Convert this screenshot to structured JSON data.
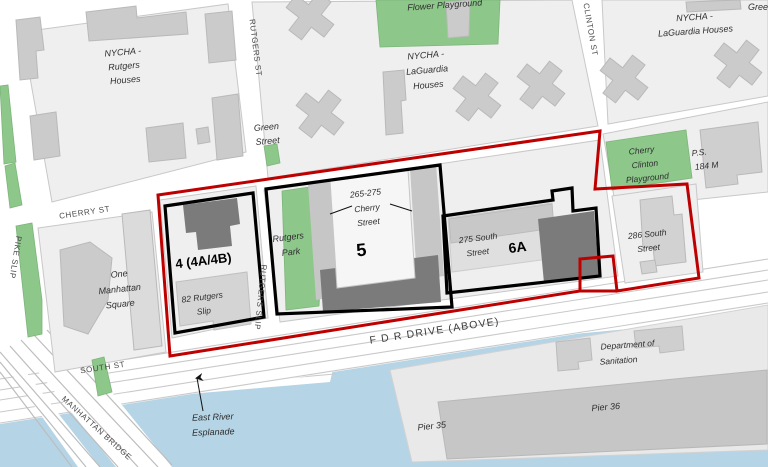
{
  "map": {
    "title": "Two Bridges site map",
    "colors": {
      "boundary_red": "#BE0000",
      "parcel_black": "#000000",
      "water": "#B5D4E6",
      "park_green": "#8DC78A",
      "block_gray": "#EFEFEF",
      "building_gray": "#CBCBCB",
      "building_dark": "#7B7B7B",
      "building_light": "#D6D6D6",
      "building_white": "#F7F7F7",
      "pier_platform": "#E9E9E9",
      "pier_building": "#C6C6C6",
      "street_white": "#FFFFFF"
    },
    "labels": {
      "nycha_rutgers": [
        "NYCHA -",
        "Rutgers",
        "Houses"
      ],
      "nycha_laguardia_mid": [
        "NYCHA -",
        "LaGuardia",
        "Houses"
      ],
      "nycha_laguardia_right": [
        "NYCHA -",
        "LaGuardia Houses"
      ],
      "flower_playground": "Flower Playground",
      "green_clipped": "Gree",
      "green_street": [
        "Green",
        "Street"
      ],
      "rutgers_st": "RUTGERS ST",
      "clinton_st": "CLINTON ST",
      "cherry_st": "CHERRY ST",
      "pike_slip": "PIKE SLIP",
      "rutgers_slip": "RUTGERS SLIP",
      "south_st": "SOUTH ST",
      "fdr_drive": "F D R DRIVE (ABOVE)",
      "manhattan_bridge": "MANHATTAN BRIDGE",
      "cherry_clinton_playground": [
        "Cherry",
        "Clinton",
        "Playground"
      ],
      "ps_184": [
        "P.S.",
        "184 M"
      ],
      "south_286": [
        "286 South",
        "Street"
      ],
      "one_manhattan_square": [
        "One",
        "Manhattan",
        "Square"
      ],
      "site_4": "4 (4A/4B)",
      "rutgers_slip_82": [
        "82 Rutgers",
        "Slip"
      ],
      "rutgers_park": [
        "Rutgers",
        "Park"
      ],
      "site_5": "5",
      "cherry_265_275": [
        "265-275",
        "Cherry",
        "Street"
      ],
      "site_6a": "6A",
      "south_275": [
        "275 South",
        "Street"
      ],
      "east_river_esplanade": [
        "East River",
        "Esplanade"
      ],
      "dept_sanitation": [
        "Department of",
        "Sanitation"
      ],
      "pier_35": "Pier 35",
      "pier_36": "Pier 36"
    }
  }
}
